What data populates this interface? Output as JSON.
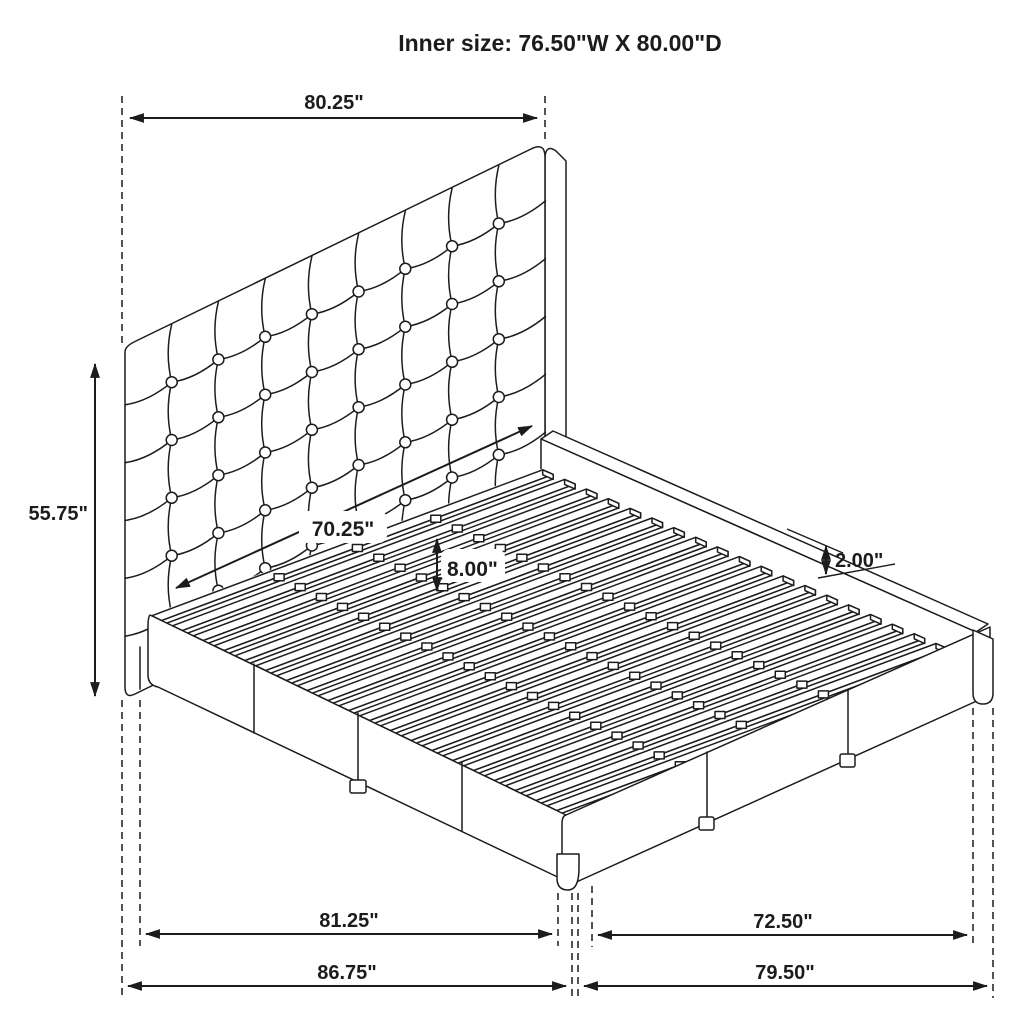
{
  "title": "Inner size: 76.50\"W X 80.00\"D",
  "dimensions": {
    "headboard_width": "80.25\"",
    "headboard_height": "55.75\"",
    "slat_area_width": "70.25\"",
    "platform_height": "8.00\"",
    "rail_lip_height": "2.00\"",
    "side_rail_length": "81.25\"",
    "overall_depth": "86.75\"",
    "footboard_inner_width": "72.50\"",
    "overall_width": "79.50\""
  },
  "figure": {
    "type": "bed-assembly-dimension-diagram",
    "tuft_columns": 9,
    "tuft_rows": 6,
    "tuft_button_radius": 5.5,
    "slat_count": 20,
    "slat_clip_positions": [
      0.3,
      0.5,
      0.7
    ],
    "line_color": "#1c1c1c",
    "background_color": "#ffffff"
  }
}
